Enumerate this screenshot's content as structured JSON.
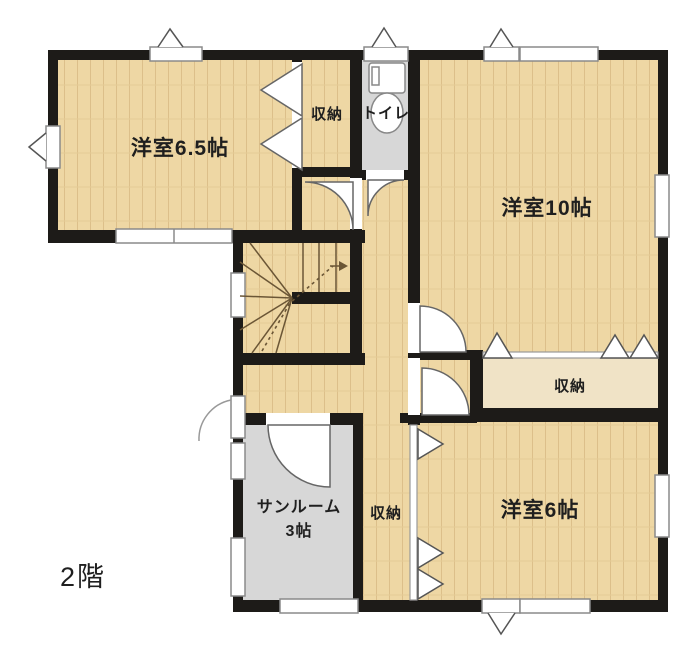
{
  "floor_plan": {
    "floor_label": "2階",
    "rooms": {
      "room_6_5": {
        "label": "洋室6.5帖"
      },
      "closet_top": {
        "label": "収納"
      },
      "toilet": {
        "label": "トイレ"
      },
      "room_10": {
        "label": "洋室10帖"
      },
      "closet_mid": {
        "label": "収納"
      },
      "sunroom": {
        "label_line1": "サンルーム",
        "label_line2": "3帖"
      },
      "closet_bottom": {
        "label": "収納"
      },
      "room_6": {
        "label": "洋室6帖"
      }
    },
    "colors": {
      "wall": "#1d1b18",
      "wood_floor": "#eed7a4",
      "wood_plank_line": "#dcbf8a",
      "tile_floor": "#d7d7d7",
      "closet_light_floor": "#f0e3c6",
      "window_fill": "#ffffff",
      "stair_line": "#6b5636"
    },
    "symbols": [
      "door-swing-arc",
      "double-closet-door",
      "bifold-door-triangles",
      "window",
      "awning-window-triangle",
      "stairs-up-dashed-arrow",
      "toilet-fixture"
    ]
  }
}
